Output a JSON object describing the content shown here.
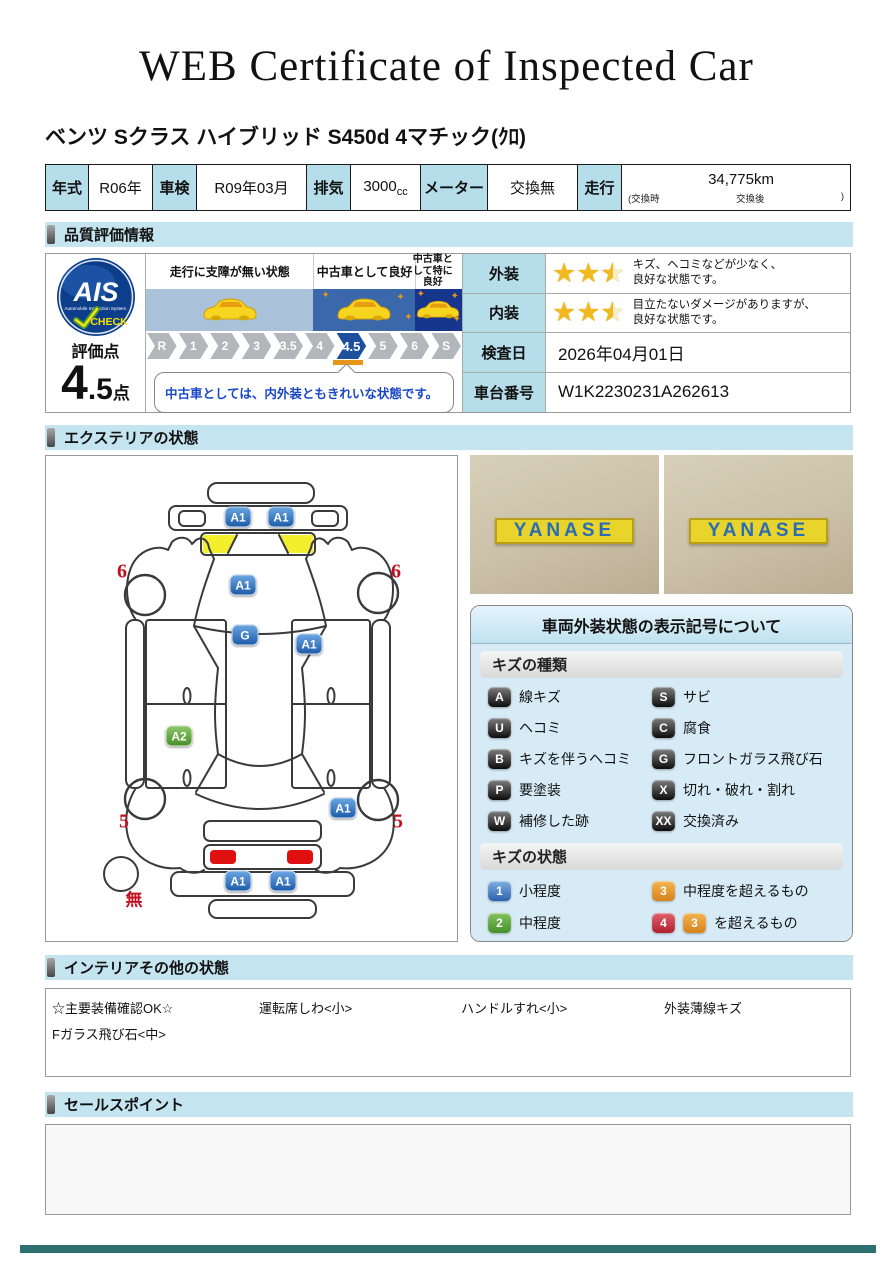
{
  "title": "WEB Certificate of Inspected Car",
  "car_name": "ベンツ Sクラス ハイブリッド S450d 4マチック(ｸﾛ)",
  "spec": {
    "year_label": "年式",
    "year": "R06年",
    "shaken_label": "車検",
    "shaken": "R09年03月",
    "displacement_label": "排気",
    "displacement": "3000",
    "displacement_unit": "cc",
    "meter_label": "メーター",
    "meter": "交換無",
    "mileage_label": "走行",
    "mileage": "34,775km",
    "mileage_note_pre": "(交換時",
    "mileage_note_mid": "交換後",
    "mileage_note_close": ")"
  },
  "sections": {
    "quality": "品質評価情報",
    "exterior": "エクステリアの状態",
    "interior": "インテリアその他の状態",
    "sales": "セールスポイント"
  },
  "quality": {
    "ais": {
      "name": "AIS",
      "sub": "Automobile Inspection System.",
      "check": "CHECK"
    },
    "score_label": "評価点",
    "score_int": "4",
    "score_dec": ".5",
    "score_unit": "点",
    "zones": [
      {
        "label": "走行に支障が無い状態",
        "color": "#a9c1d9"
      },
      {
        "label": "中古車として良好",
        "color": "#3a68ab"
      },
      {
        "label": "中古車として特に良好",
        "color": "#16368e"
      }
    ],
    "scale": [
      "R",
      "1",
      "2",
      "3",
      "3.5",
      "4",
      "4.5",
      "5",
      "6",
      "S"
    ],
    "active_step": "4.5",
    "comment": "中古車としては、内外装ともきれいな状態です。",
    "exterior_row": {
      "label": "外装",
      "stars": 2.5,
      "line1": "キズ、ヘコミなどが少なく、",
      "line2": "良好な状態です。"
    },
    "interior_row": {
      "label": "内装",
      "stars": 2.5,
      "line1": "目立たないダメージがありますが、",
      "line2": "良好な状態です。"
    },
    "date_row": {
      "label": "検査日",
      "value": "2026年04月01日"
    },
    "vin_row": {
      "label": "車台番号",
      "value": "W1K2230231A262613"
    }
  },
  "diagram": {
    "markers": [
      {
        "code": "A1",
        "type": "blue",
        "x": 192,
        "y": 61
      },
      {
        "code": "A1",
        "type": "blue",
        "x": 235,
        "y": 61
      },
      {
        "code": "A1",
        "type": "blue",
        "x": 197,
        "y": 129
      },
      {
        "code": "G",
        "type": "blue",
        "x": 199,
        "y": 179
      },
      {
        "code": "A1",
        "type": "blue",
        "x": 263,
        "y": 188
      },
      {
        "code": "A2",
        "type": "green",
        "x": 133,
        "y": 280
      },
      {
        "code": "A1",
        "type": "blue",
        "x": 297,
        "y": 352
      },
      {
        "code": "A1",
        "type": "blue",
        "x": 192,
        "y": 425
      },
      {
        "code": "A1",
        "type": "blue",
        "x": 237,
        "y": 425
      }
    ],
    "labels": [
      {
        "text": "6",
        "x": 76,
        "y": 116
      },
      {
        "text": "6",
        "x": 350,
        "y": 116
      },
      {
        "text": "5",
        "x": 78,
        "y": 366
      },
      {
        "text": "5",
        "x": 352,
        "y": 366
      },
      {
        "text": "無",
        "x": 88,
        "y": 442
      }
    ]
  },
  "photos": [
    {
      "sign": "YANASE"
    },
    {
      "sign": "YANASE"
    }
  ],
  "legend": {
    "title": "車両外装状態の表示記号について",
    "kind_header": "キズの種類",
    "kinds": [
      {
        "code": "A",
        "label": "線キズ"
      },
      {
        "code": "S",
        "label": "サビ"
      },
      {
        "code": "U",
        "label": "ヘコミ"
      },
      {
        "code": "C",
        "label": "腐食"
      },
      {
        "code": "B",
        "label": "キズを伴うヘコミ"
      },
      {
        "code": "G",
        "label": "フロントガラス飛び石"
      },
      {
        "code": "P",
        "label": "要塗装"
      },
      {
        "code": "X",
        "label": "切れ・破れ・割れ"
      },
      {
        "code": "W",
        "label": "補修した跡"
      },
      {
        "code": "XX",
        "label": "交換済み"
      }
    ],
    "state_header": "キズの状態",
    "states": [
      {
        "code": "1",
        "type": "blue",
        "label": "小程度"
      },
      {
        "code": "3",
        "type": "orange",
        "label": "中程度を超えるもの"
      },
      {
        "code": "2",
        "type": "green",
        "label": "中程度"
      },
      {
        "code": "4",
        "type": "red",
        "extra_code": "3",
        "extra_type": "orange",
        "label": "を超えるもの"
      }
    ]
  },
  "interior": {
    "items": [
      "☆主要装備確認OK☆",
      "運転席しわ<小>",
      "ハンドルすれ<小>",
      "外装薄線キズ",
      "Fガラス飛び石<中>"
    ]
  },
  "colors": {
    "header_bar": "#c4e4ef",
    "table_header": "#b5deea",
    "footer_teal": "#2d6e6e",
    "star_gold": "#f2b91e"
  }
}
